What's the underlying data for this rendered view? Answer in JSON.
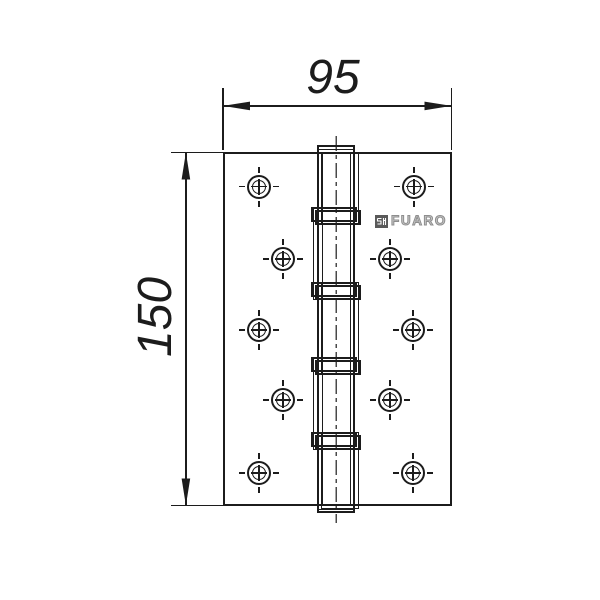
{
  "drawing_type": "door-hinge-technical-drawing",
  "canvas": {
    "width": 600,
    "height": 600,
    "background": "#ffffff",
    "line_color": "#1c1c1c"
  },
  "dimensions": {
    "width": {
      "label": "95",
      "orientation": "horizontal"
    },
    "height": {
      "label": "150",
      "orientation": "vertical"
    }
  },
  "brand": {
    "name": "FUARO",
    "icon": "fuaro-monogram-icon",
    "text_color": "#9b9b9b"
  },
  "plate": {
    "x": 223,
    "y": 152,
    "width": 229,
    "height": 354
  },
  "barrel": {
    "x": 317,
    "y": 145,
    "width": 38,
    "height": 368,
    "pin_axis_x": 336,
    "pin_axis_y1": 136,
    "pin_axis_y2": 523,
    "inner_line_xs": [
      321.5,
      350
    ],
    "cap_line_ys": [
      148.5,
      509
    ],
    "bearings_y": [
      207,
      282,
      357,
      432
    ],
    "knuckles_right": [
      {
        "y1": 152,
        "y2": 225
      },
      {
        "y1": 282,
        "y2": 375
      },
      {
        "y1": 432,
        "y2": 509
      }
    ],
    "knuckles_left": [
      {
        "y1": 207,
        "y2": 300
      },
      {
        "y1": 357,
        "y2": 450
      }
    ]
  },
  "holes": [
    {
      "cx": 259,
      "cy": 186.5
    },
    {
      "cx": 283,
      "cy": 259
    },
    {
      "cx": 259,
      "cy": 330
    },
    {
      "cx": 283,
      "cy": 400
    },
    {
      "cx": 259,
      "cy": 473
    },
    {
      "cx": 414,
      "cy": 186.5
    },
    {
      "cx": 390,
      "cy": 259
    },
    {
      "cx": 413,
      "cy": 330
    },
    {
      "cx": 390,
      "cy": 400
    },
    {
      "cx": 413,
      "cy": 473
    }
  ]
}
